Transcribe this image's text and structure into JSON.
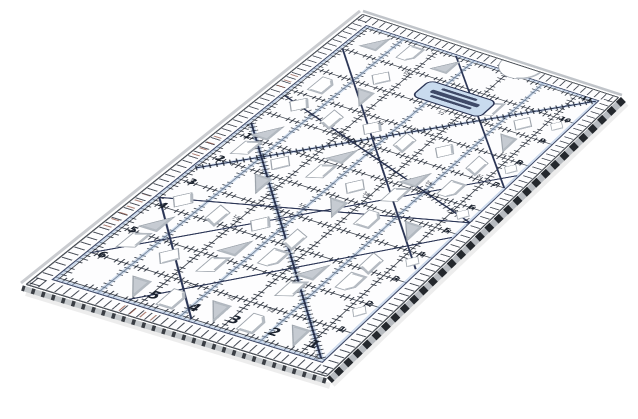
{
  "meta": {
    "alt": "Clear acrylic quilting ruler with black grid tick markings, navy diagonal bias lines, light-blue highlight bands, diamond and triangle cutout holes, a circular notch and a blue brand sticker, photographed at an angle on a white background"
  },
  "colors": {
    "face": "#fdfdfe",
    "tick": "#1b222e",
    "navy": "#2b3555",
    "blue": "#a8c0de",
    "red": "#8a4a3a",
    "holestroke": "#9aa1a9",
    "holeshade": "#b2b8c0",
    "holetri": "#c6cbd2",
    "labelbg": "#c9dbee",
    "border": "#4b5057",
    "edgedark": "#24282d",
    "edgelight": "#b7bbc0",
    "edgedark2": "#3a3e44",
    "edgelight2": "#c6cacd",
    "edgefar": "#caccd0",
    "edgetop": "#c0c4c9"
  },
  "ruler": {
    "left_scale": [
      "1",
      "2",
      "3",
      "4",
      "5"
    ],
    "top_scale": [
      "6",
      "5",
      "4",
      "3",
      "2",
      "1"
    ],
    "bottom_scale": [
      "1",
      "2",
      "3",
      "4",
      "5",
      "6",
      "7",
      "8",
      "9",
      "10",
      "11"
    ],
    "fractions": [
      "¼",
      "½",
      "¾"
    ]
  }
}
